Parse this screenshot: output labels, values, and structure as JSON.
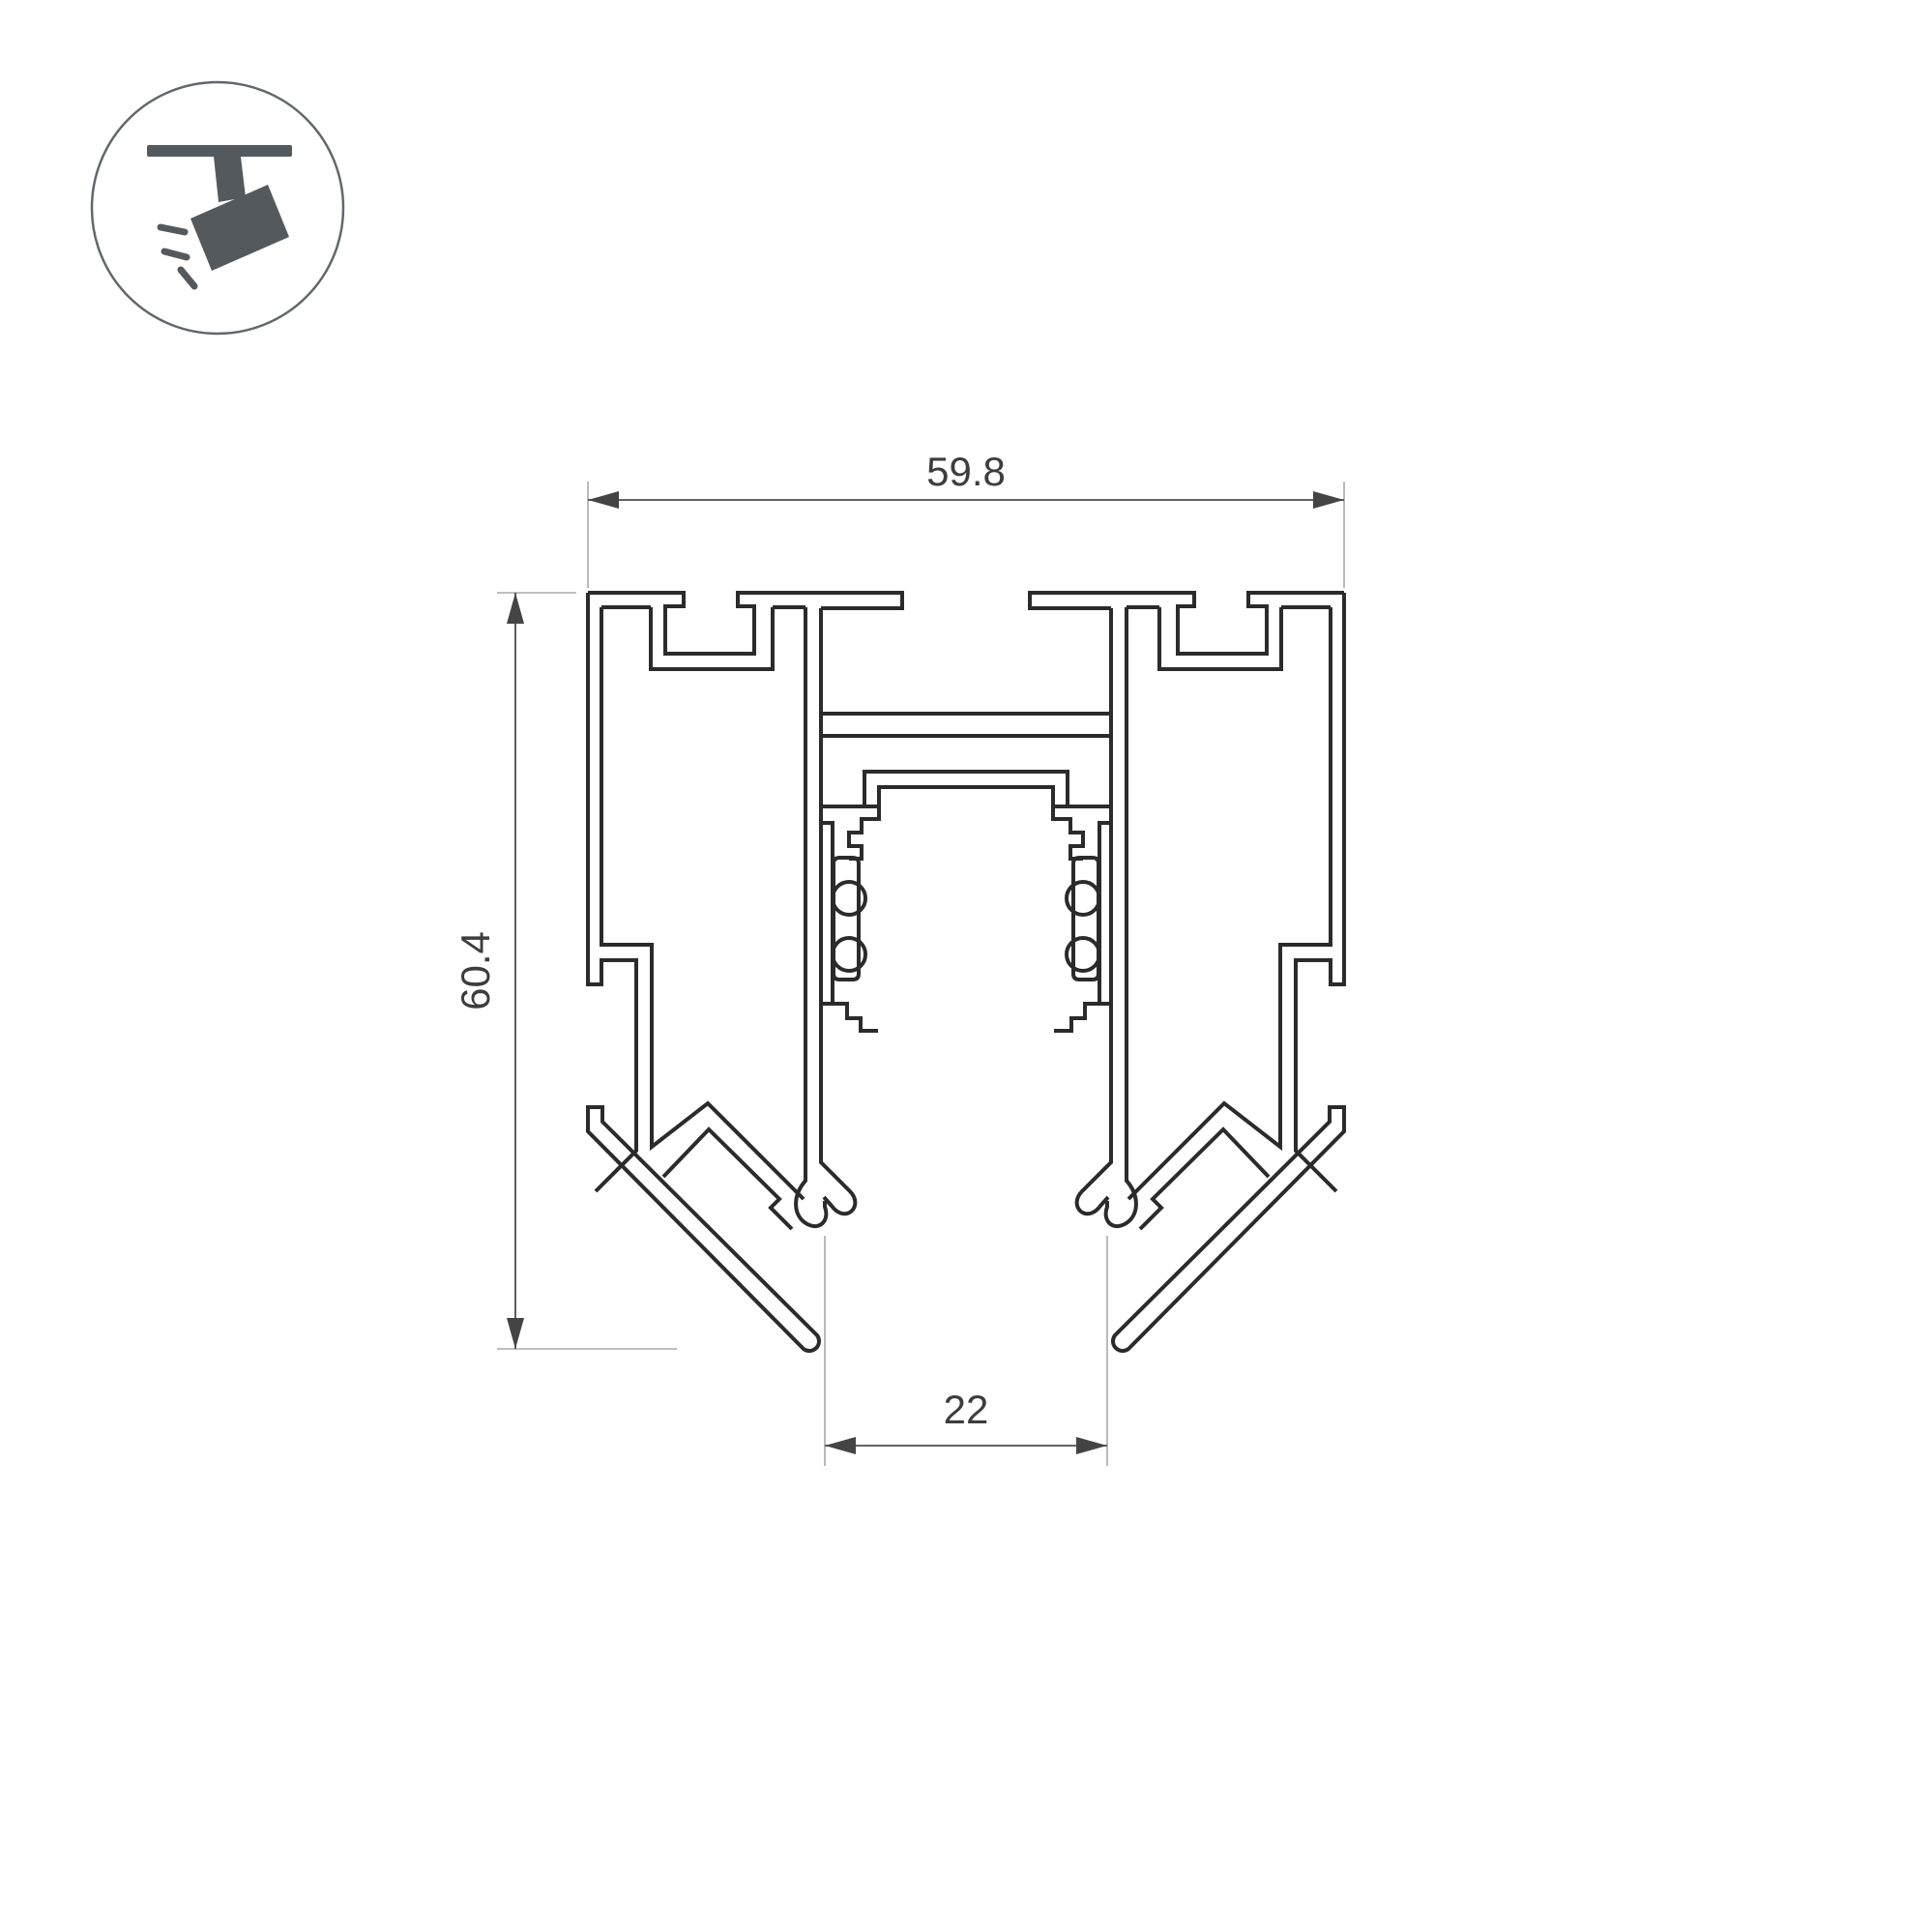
{
  "logo": {
    "name": "track-light-logo",
    "circle_color": "#62676b",
    "icon_color": "#54595e"
  },
  "drawing": {
    "type": "profile-cross-section",
    "description": "magnetic track lighting aluminum profile section view",
    "line_color": "#2b2b2b",
    "dim_line_color": "#4d4d4d",
    "extension_line_color": "#a8a8a8",
    "text_color": "#3d3d3d"
  },
  "dimensions": {
    "width_top": "59.8",
    "height_left": "60.4",
    "slot_bottom": "22"
  }
}
